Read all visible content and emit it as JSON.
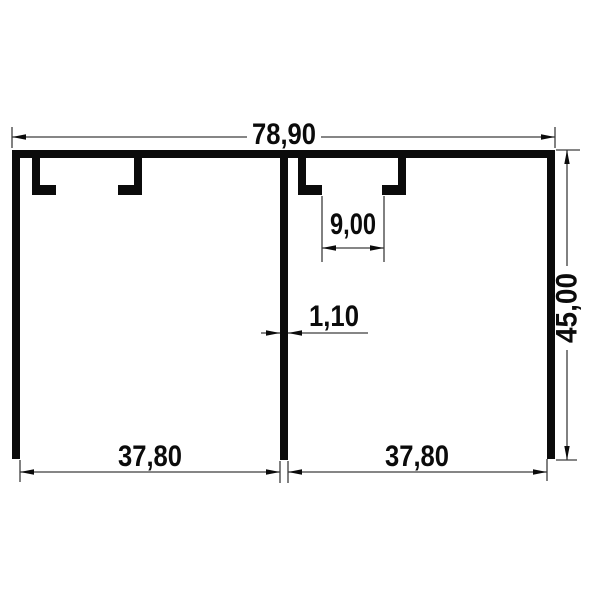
{
  "page": {
    "background_color": "#ffffff"
  },
  "drawing": {
    "kind": "technical-cross-section",
    "description": "Dual-track extruded profile cross-section with dimension annotations",
    "profile_color": "#0b0b0b",
    "dimension_line_color": "#3d3d3d",
    "text_color": "#0b0b0b",
    "dims": {
      "total_width": "78,90",
      "groove_width": "9,00",
      "wall_thickness": "1,10",
      "height": "45,00",
      "left_bay_width": "37,80",
      "right_bay_width": "37,80"
    }
  }
}
